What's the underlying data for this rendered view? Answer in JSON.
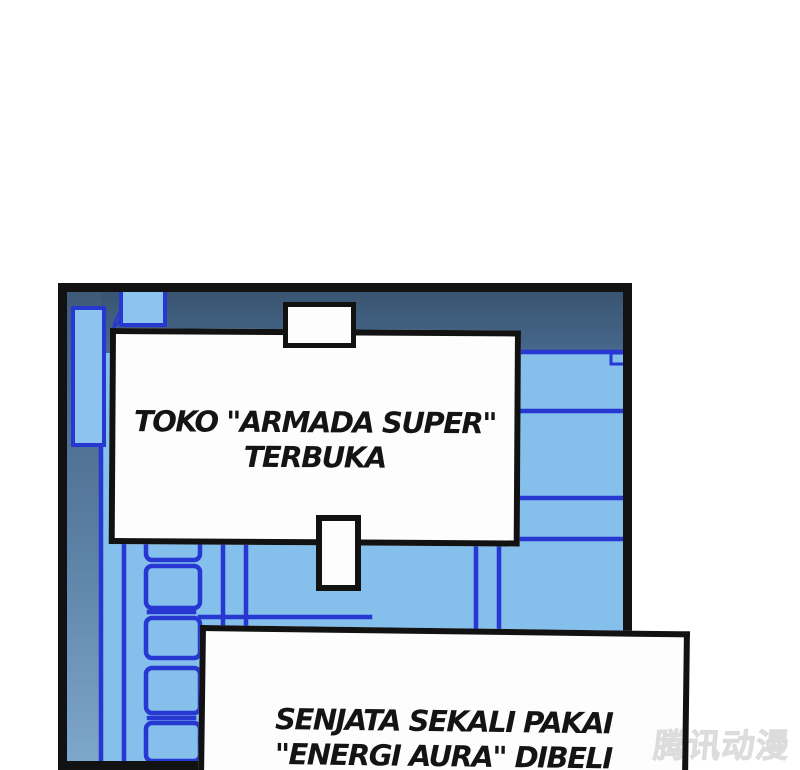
{
  "panel": {
    "background_color": "#85bfec",
    "top_band_color": "#3d5a78",
    "left_wall_top_color": "#41617f",
    "left_wall_bottom_color": "#7ea8cc",
    "structure_line_color": "#2737d2",
    "border_color": "#121212",
    "caption_fill": "#fdfdfd"
  },
  "captions": {
    "shop_open": {
      "line1": "TOKO \"ARMADA SUPER\"",
      "line2": "TERBUKA"
    },
    "weapon_purchase": {
      "line1": "SENJATA SEKALI PAKAI",
      "line2": "\"ENERGI AURA\" DIBELI"
    }
  },
  "watermark": {
    "text": "腾讯动漫"
  }
}
